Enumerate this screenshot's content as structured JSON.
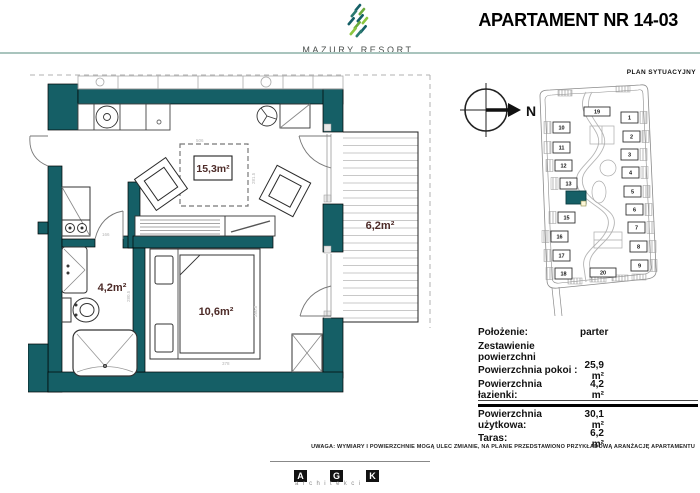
{
  "header": {
    "logo_text": "MAZURY RESORT",
    "title": "APARTAMENT NR 14-03"
  },
  "compass": {
    "label": "N"
  },
  "site_plan": {
    "title": "PLAN SYTUACYJNY",
    "buildings": [
      {
        "n": "1",
        "x": 93,
        "y": 36,
        "side": "R"
      },
      {
        "n": "2",
        "x": 95,
        "y": 55,
        "side": "R"
      },
      {
        "n": "3",
        "x": 93,
        "y": 73,
        "side": "R"
      },
      {
        "n": "4",
        "x": 94,
        "y": 91,
        "side": "R"
      },
      {
        "n": "5",
        "x": 96,
        "y": 110,
        "side": "R"
      },
      {
        "n": "6",
        "x": 98,
        "y": 128,
        "side": "R"
      },
      {
        "n": "7",
        "x": 100,
        "y": 146,
        "side": "R"
      },
      {
        "n": "8",
        "x": 102,
        "y": 165,
        "side": "R"
      },
      {
        "n": "9",
        "x": 103,
        "y": 184,
        "side": "R"
      },
      {
        "n": "10",
        "x": 25,
        "y": 46,
        "side": "L"
      },
      {
        "n": "11",
        "x": 25,
        "y": 66,
        "side": "L"
      },
      {
        "n": "12",
        "x": 27,
        "y": 84,
        "side": "L"
      },
      {
        "n": "13",
        "x": 32,
        "y": 102,
        "side": "L"
      },
      {
        "n": "14",
        "x": 38,
        "y": 115,
        "highlighted": true
      },
      {
        "n": "15",
        "x": 30,
        "y": 136,
        "side": "L"
      },
      {
        "n": "16",
        "x": 23,
        "y": 155,
        "side": "L"
      },
      {
        "n": "17",
        "x": 25,
        "y": 174,
        "side": "L"
      },
      {
        "n": "18",
        "x": 27,
        "y": 192,
        "side": "L"
      },
      {
        "n": "19",
        "x": 56,
        "y": 31,
        "wide": true
      },
      {
        "n": "20",
        "x": 62,
        "y": 192,
        "wide": true
      }
    ]
  },
  "floor_plan": {
    "labels": {
      "living": "15,3m²",
      "bathroom": "4,2m²",
      "bedroom": "10,6m²",
      "terrace": "6,2m²"
    },
    "dimensions": {
      "living_width": "506",
      "living_height": "281.5",
      "bathroom_width": "166",
      "bathroom_height": "280.5",
      "bedroom_height": "280.5",
      "bedroom_width": "378"
    }
  },
  "details_table": {
    "rows": [
      {
        "label": "Położenie:",
        "value": "parter"
      },
      {
        "label": "Zestawienie powierzchni",
        "value": ""
      },
      {
        "label": "Powierzchnia pokoi :",
        "value": "25,9 m²"
      },
      {
        "label": "Powierzchnia łazienki:",
        "value": "4,2 m²"
      },
      {
        "label": "Powierzchnia użytkowa:",
        "value": "30,1 m²"
      },
      {
        "label": "Taras:",
        "value": "6,2 m²"
      }
    ]
  },
  "note": "UWAGA: WYMIARY I POWIERZCHNIE MOGĄ ULEC ZMIANIE, NA PLANIE PRZEDSTAWIONO PRZYKŁADOWĄ ARANŻACJĘ APARTAMENTU",
  "footer": {
    "letters": [
      "A",
      "G",
      "K"
    ],
    "subtitle": "architekci"
  },
  "colors": {
    "wall_teal": "#155f66",
    "accent_green": "#6aaa3c",
    "label_maroon": "#4d2b28"
  }
}
